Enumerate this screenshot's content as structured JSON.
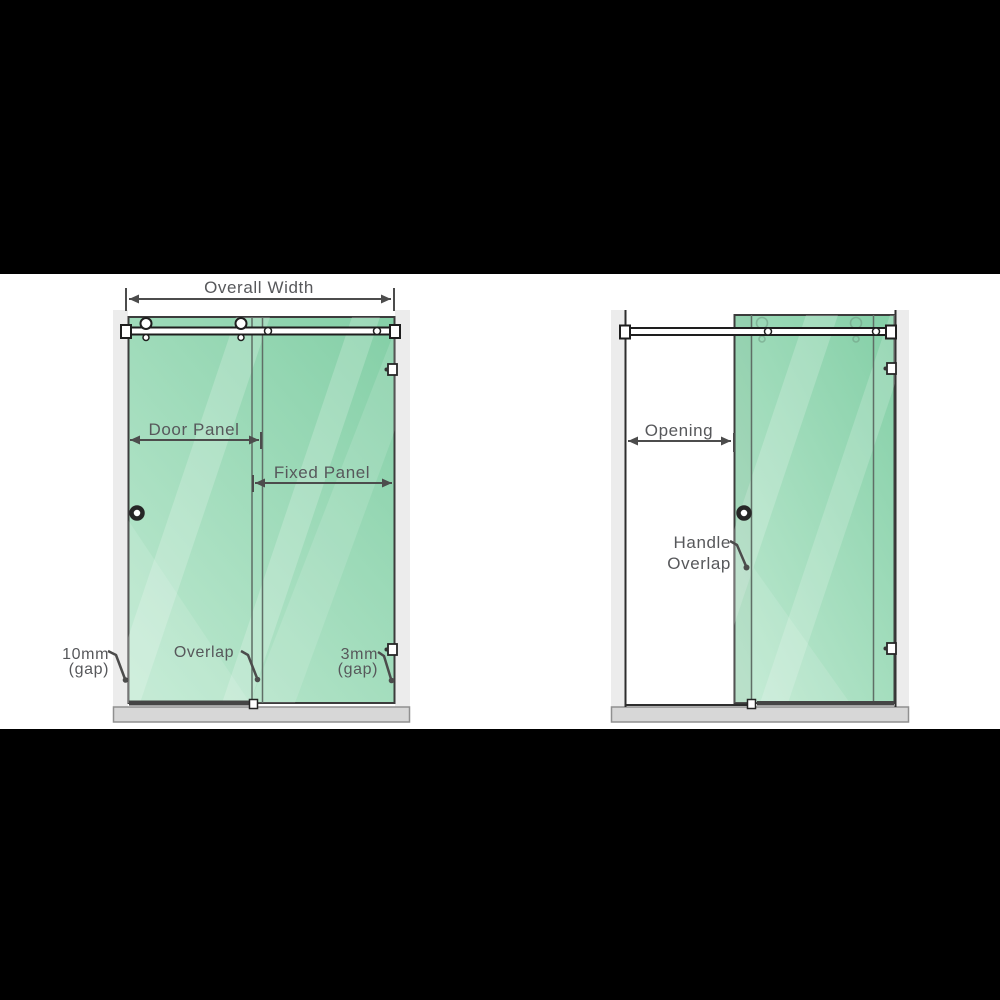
{
  "diagram_title": "Sliding shower door dimension diagram",
  "colors": {
    "background": "#000000",
    "canvas": "#ffffff",
    "glass_top": "#86d0a8",
    "glass_bottom": "#bce8cf",
    "frame_line": "#2e2e2e",
    "dimension_line": "#4c4c4c",
    "label_text": "#57585b",
    "tray_fill": "#d7d7d7",
    "wall_strip": "#ececec",
    "seal": "#454545"
  },
  "closed_view": {
    "overall_width_label": "Overall Width",
    "door_panel_label": "Door Panel",
    "fixed_panel_label": "Fixed Panel",
    "left_gap_value": "10mm",
    "left_gap_unit": "(gap)",
    "overlap_label": "Overlap",
    "right_gap_value": "3mm",
    "right_gap_unit": "(gap)"
  },
  "open_view": {
    "opening_label": "Opening",
    "handle_overlap_line1": "Handle",
    "handle_overlap_line2": "Overlap"
  }
}
